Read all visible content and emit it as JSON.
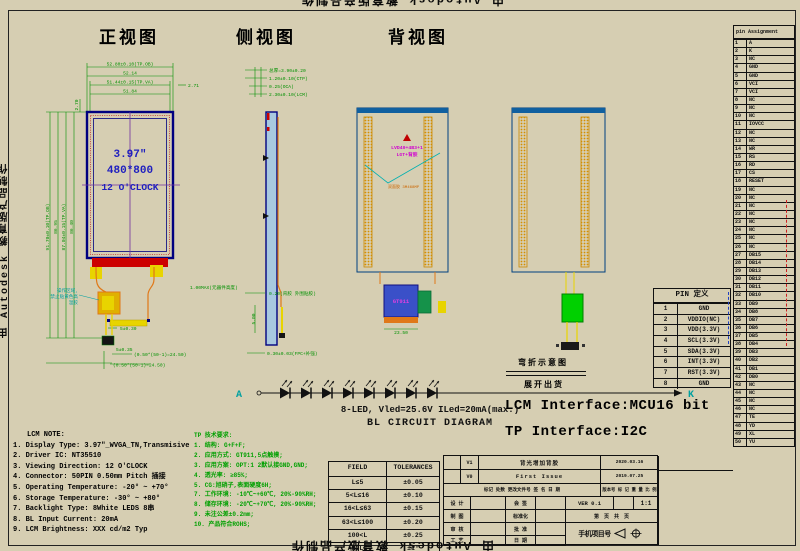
{
  "watermark": {
    "text": "由 Autodesk 教育版产品制作"
  },
  "views": {
    "front": "正视图",
    "side": "侧视图",
    "back": "背视图"
  },
  "front": {
    "screen": {
      "size": "3.97″",
      "resolution": "480*800",
      "clock": "12 O'CLOCK"
    },
    "dims_top": [
      "52.80±0.10(TP.OB)",
      "52.14",
      "51.44±0.15(TP.VA)",
      "51.84"
    ],
    "dim_top_right": "2.71",
    "dim_top_left": "2.70",
    "dims_left": [
      "91.70±0.10(TP.OB)",
      "86.95",
      "87.04±0.15(TP.VA)",
      "86.40"
    ],
    "dims_bottom": [
      "5±0.30",
      "(0.50*(50-1)=24.50)",
      "5±0.35",
      "(0.50*(50-1)=24.50)"
    ],
    "note_area": [
      "操作区域,",
      "禁止贴黄色高",
      "温胶"
    ],
    "note_height": "1.00MAX(元器件高度)"
  },
  "side": {
    "dims_top": [
      "总厚=3.90±0.20",
      "1.20±0.10(CTP)",
      "0.25(OCA)",
      "2.30±0.10(LCM)"
    ],
    "dims_bottom": [
      "0.20(背胶 外围贴胶)",
      "5.00",
      "0.30±0.03(FPC+补强)"
    ]
  },
  "back": {
    "label_line1": "LVD40+4B3+1",
    "label_line2": "LGT+背胶",
    "tape_note": "双面胶 3M468MP",
    "chip": "GT911",
    "dim_width": "23.50"
  },
  "bend": {
    "title": "弯折示意图",
    "subtitle": "展开出货"
  },
  "interfaces": {
    "lcm": "LCM Interface:MCU16 bit",
    "tp": "TP Interface:I2C"
  },
  "bl": {
    "anode": "A",
    "cathode": "K",
    "label": "8-LED, Vled=25.6V ILed=20mA(max.)",
    "title": "BL CIRCUIT DIAGRAM"
  },
  "lcm_note": {
    "title": "LCM NOTE:",
    "lines": [
      "1. Display Type: 3.97\"_WVGA_TN,Transmisive",
      "2. Driver IC: NT35510",
      "3. Viewing Direction: 12 O'CLOCK",
      "4. Connector: 50PIN 0.50mm Pitch 插接",
      "5. Operating Temperature: -20° ~  +70°",
      "6. Storage Temperature: -30° ~  +80°",
      "7. Backlight Type: 8White LEDS 8串",
      "8. BL Input Current: 20mA",
      "9. LCM Brightness: XXX cd/m2  Typ"
    ]
  },
  "tp_note": {
    "title": "TP 技术要求:",
    "lines": [
      "1. 结构: G+F+F;",
      "2. 应用方式: GT911,5点触摸;",
      "3. 应用方案: OPT:1 2默认接GND,GND;",
      "4. 透光率: ≥85%;",
      "5. CG:旭硝子,表面硬度6H;",
      "7. 工作环境: -10℃~+60℃, 20%-90%RH;",
      "8. 储存环境: -20℃~+70℃, 20%-90%RH;",
      "9. 未注公差±0.2mm;",
      "10. 产品符合ROHS;"
    ]
  },
  "tolerance_table": {
    "headers": [
      "FIELD",
      "TOLERANCES"
    ],
    "rows": [
      [
        "L≤5",
        "±0.05"
      ],
      [
        "5<L≤16",
        "±0.10"
      ],
      [
        "16<L≤63",
        "±0.15"
      ],
      [
        "63<L≤100",
        "±0.20"
      ],
      [
        "100<L",
        "±0.25"
      ],
      [
        "ANGLE",
        "±1°"
      ]
    ]
  },
  "pin_def": {
    "title": "PIN 定义",
    "rows": [
      [
        "1",
        "GND"
      ],
      [
        "2",
        "VDDIO(NC)"
      ],
      [
        "3",
        "VDD(3.3V)"
      ],
      [
        "4",
        "SCL(3.3V)"
      ],
      [
        "5",
        "SDA(3.3V)"
      ],
      [
        "6",
        "INT(3.3V)"
      ],
      [
        "7",
        "RST(3.3V)"
      ],
      [
        "8",
        "GND"
      ]
    ]
  },
  "pin_assignment": {
    "title": "pin Assignment",
    "rows": [
      [
        "1",
        "A"
      ],
      [
        "2",
        "K"
      ],
      [
        "3",
        "NC"
      ],
      [
        "4",
        "GND"
      ],
      [
        "5",
        "GND"
      ],
      [
        "6",
        "VCI"
      ],
      [
        "7",
        "VCI"
      ],
      [
        "8",
        "NC"
      ],
      [
        "9",
        "NC"
      ],
      [
        "10",
        "NC"
      ],
      [
        "11",
        "IOVCC"
      ],
      [
        "12",
        "NC"
      ],
      [
        "13",
        "NC"
      ],
      [
        "14",
        "WR"
      ],
      [
        "15",
        "RS"
      ],
      [
        "16",
        "RD"
      ],
      [
        "17",
        "CS"
      ],
      [
        "18",
        "RESET"
      ],
      [
        "19",
        "NC"
      ],
      [
        "20",
        "NC"
      ],
      [
        "21",
        "NC"
      ],
      [
        "22",
        "NC"
      ],
      [
        "23",
        "NC"
      ],
      [
        "24",
        "NC"
      ],
      [
        "25",
        "NC"
      ],
      [
        "26",
        "NC"
      ],
      [
        "27",
        "DB15"
      ],
      [
        "28",
        "DB14"
      ],
      [
        "29",
        "DB13"
      ],
      [
        "30",
        "DB12"
      ],
      [
        "31",
        "DB11"
      ],
      [
        "32",
        "DB10"
      ],
      [
        "33",
        "DB9"
      ],
      [
        "34",
        "DB8"
      ],
      [
        "35",
        "DB7"
      ],
      [
        "36",
        "DB6"
      ],
      [
        "37",
        "DB5"
      ],
      [
        "38",
        "DB4"
      ],
      [
        "39",
        "DB3"
      ],
      [
        "40",
        "DB2"
      ],
      [
        "41",
        "DB1"
      ],
      [
        "42",
        "DB0"
      ],
      [
        "43",
        "NC"
      ],
      [
        "44",
        "NC"
      ],
      [
        "45",
        "NC"
      ],
      [
        "46",
        "NC"
      ],
      [
        "47",
        "TE"
      ],
      [
        "48",
        "YD"
      ],
      [
        "49",
        "XL"
      ],
      [
        "50",
        "YU"
      ]
    ]
  },
  "title_block": {
    "revisions": [
      {
        "mark": "V1",
        "desc": "背光增加背胶",
        "date": "2020.03.16"
      },
      {
        "mark": "V0",
        "desc": "First Issue",
        "date": "2019.07.25"
      }
    ],
    "header_left": "标记 处数 更改文件号 签  名  日  期",
    "header_right": "版本号 标 记 重 量 比 例",
    "ver": "VER 0.1",
    "scale": "1:1",
    "pages": "第  页 共  页",
    "labels": {
      "design": "设 计",
      "draw": "制 图",
      "check": "审 核",
      "craft": "工 艺",
      "countersign": "会 签",
      "standard": "标准化",
      "approve": "批 准",
      "date": "日 期"
    },
    "project": "手机项目号"
  }
}
